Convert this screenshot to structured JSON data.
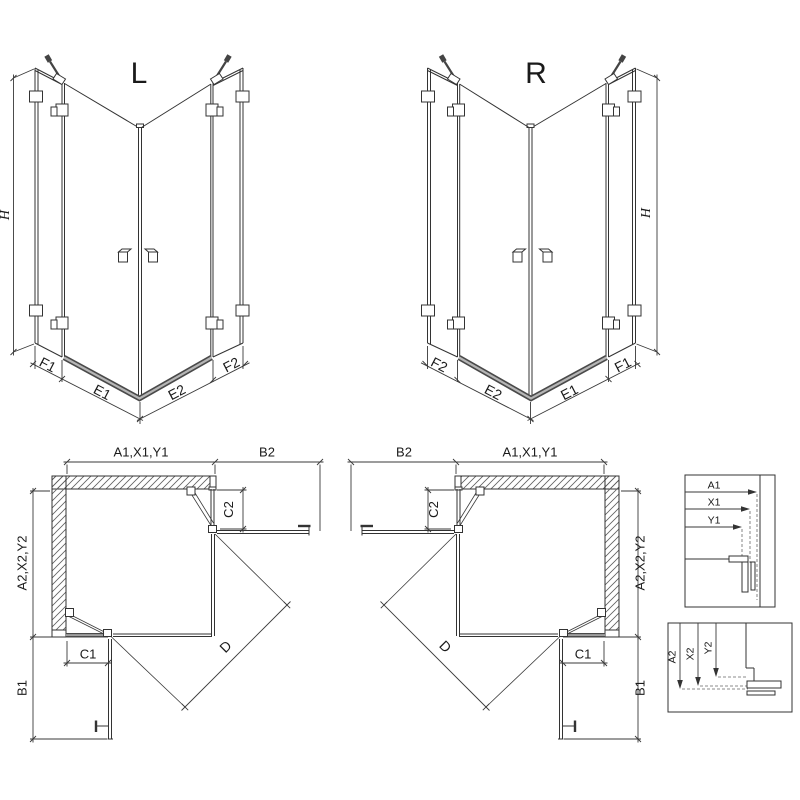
{
  "drawing": {
    "type": "shower-enclosure-technical-diagram",
    "front_views": {
      "left": {
        "label": "L",
        "height_dim": "H",
        "bottom_dims": {
          "f1": "F1",
          "e1": "E1",
          "e2": "E2",
          "f2": "F2"
        }
      },
      "right": {
        "label": "R",
        "height_dim": "H",
        "bottom_dims": {
          "f1": "F1",
          "e1": "E1",
          "e2": "E2",
          "f2": "F2"
        }
      }
    },
    "plan_views": {
      "left": {
        "width_dim": "A1,X1,Y1",
        "door_side_dim": "B2",
        "fixed_top_dim": "C2",
        "depth_dim": "A2,X2,Y2",
        "fixed_bottom_dim": "C1",
        "door_bottom_dim": "B1",
        "diagonal_dim": "D"
      },
      "right": {
        "width_dim": "A1,X1,Y1",
        "door_side_dim": "B2",
        "fixed_top_dim": "C2",
        "depth_dim": "A2,X2,Y2",
        "fixed_bottom_dim": "C1",
        "door_bottom_dim": "B1",
        "diagonal_dim": "D"
      }
    },
    "detail_boxes": {
      "top": {
        "dims": {
          "a1": "A1",
          "x1": "X1",
          "y1": "Y1"
        }
      },
      "bottom": {
        "dims": {
          "a2": "A2",
          "x2": "X2",
          "y2": "Y2"
        }
      }
    },
    "colors": {
      "line": "#333333",
      "dimension_line": "#3a3a3a",
      "threshold_dark": "#4a4a4a",
      "threshold_light": "#b5b5b5",
      "hatch": "#606060",
      "background": "#ffffff"
    }
  }
}
